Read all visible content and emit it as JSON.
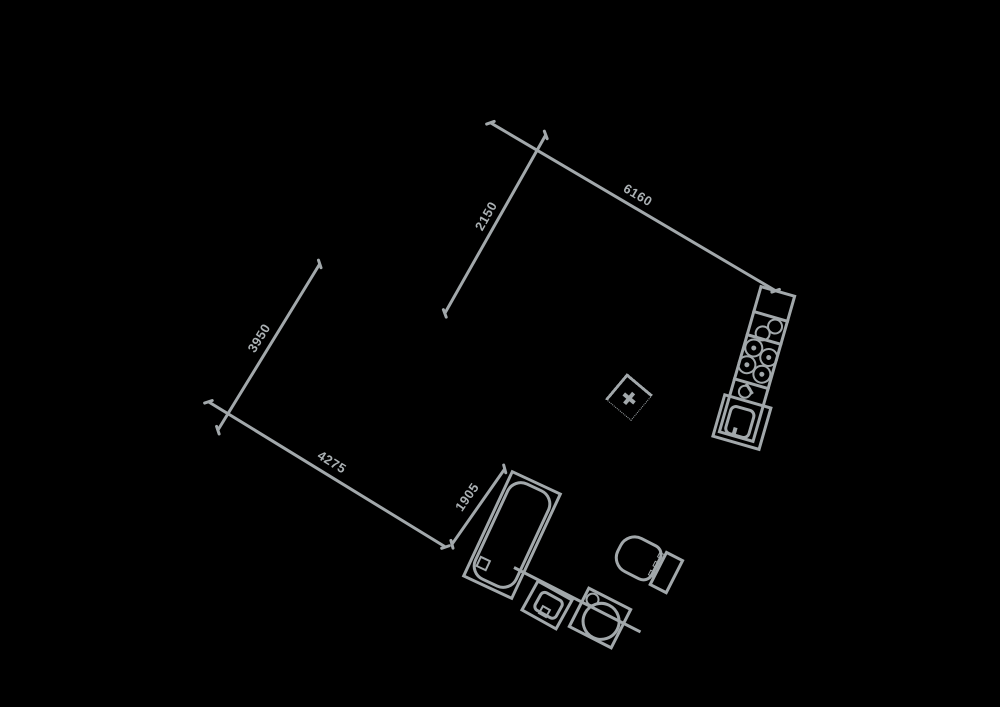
{
  "drawing": {
    "type": "floor-plan",
    "background_color": "#000000",
    "line_color": "#a2a8ab",
    "text_color": "#abb1b4"
  },
  "dimensions": [
    {
      "label": "6160"
    },
    {
      "label": "2150"
    },
    {
      "label": "3950"
    },
    {
      "label": "4275"
    },
    {
      "label": "1905"
    }
  ],
  "fixtures": {
    "bathtub": "bathtub",
    "toilet": "toilet",
    "washbasin": "washbasin",
    "sink": "sink",
    "kitchen_counter": "kitchen-counter",
    "stove": "stove-burners",
    "kitchen_faucet": "kitchen-faucet",
    "appliance": "appliance",
    "column_marker": "column-marker",
    "wall": "wall"
  }
}
